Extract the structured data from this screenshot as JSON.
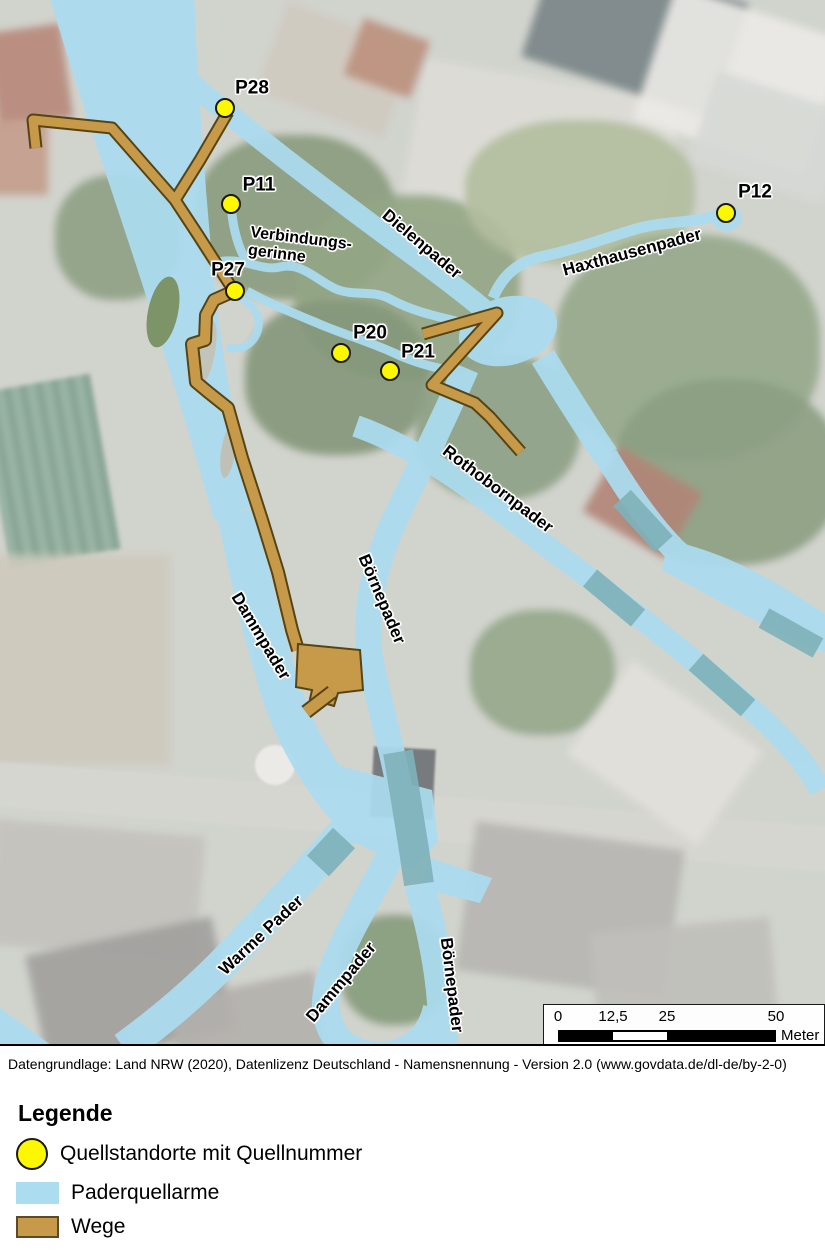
{
  "map": {
    "springs": [
      {
        "id": "P28",
        "x": 225,
        "y": 108,
        "lx": 252,
        "ly": 88
      },
      {
        "id": "P11",
        "x": 231,
        "y": 204,
        "lx": 259,
        "ly": 185
      },
      {
        "id": "P27",
        "x": 235,
        "y": 291,
        "lx": 228,
        "ly": 270
      },
      {
        "id": "P20",
        "x": 341,
        "y": 353,
        "lx": 370,
        "ly": 333
      },
      {
        "id": "P21",
        "x": 390,
        "y": 371,
        "lx": 418,
        "ly": 352
      },
      {
        "id": "P12",
        "x": 726,
        "y": 213,
        "lx": 755,
        "ly": 192
      }
    ],
    "channel_labels": [
      {
        "slug": "verbindungsgerinne",
        "text": "Verbindungs-\ngerinne",
        "x": 300,
        "y": 248,
        "rot": 7,
        "size": 16
      },
      {
        "slug": "dielenpader",
        "text": "Dielenpader",
        "x": 422,
        "y": 244,
        "rot": 40
      },
      {
        "slug": "haxthausenpader",
        "text": "Haxthausenpader",
        "x": 632,
        "y": 252,
        "rot": -15
      },
      {
        "slug": "rothobornpader",
        "text": "Rothobornpader",
        "x": 498,
        "y": 489,
        "rot": 37
      },
      {
        "slug": "boernepader-mitte",
        "text": "Börnepader",
        "x": 382,
        "y": 599,
        "rot": 67
      },
      {
        "slug": "dammpader-mitte",
        "text": "Dammpader",
        "x": 261,
        "y": 636,
        "rot": 59
      },
      {
        "slug": "warme-pader",
        "text": "Warme Pader",
        "x": 261,
        "y": 935,
        "rot": -43
      },
      {
        "slug": "dammpader-sued",
        "text": "Dammpader",
        "x": 341,
        "y": 982,
        "rot": -50
      },
      {
        "slug": "boernepader-sued",
        "text": "Börnepader",
        "x": 452,
        "y": 985,
        "rot": 83
      }
    ],
    "scalebar": {
      "ticks": [
        "0",
        "12,5",
        "25",
        "50"
      ],
      "tick_px": [
        14,
        69,
        123,
        232
      ],
      "unit": "Meter"
    }
  },
  "attribution": "Datengrundlage: Land NRW (2020), Datenlizenz Deutschland - Namensnennung - Version 2.0 (www.govdata.de/dl-de/by-2-0)",
  "legend": {
    "title": "Legende",
    "items": [
      {
        "label": "Quellstandorte mit Quellnummer",
        "swatch": "circle-yellow"
      },
      {
        "label": "Paderquellarme",
        "swatch": "rect-blue"
      },
      {
        "label": "Wege",
        "swatch": "rect-brown"
      }
    ]
  },
  "colors": {
    "water": "#abdcf0",
    "culvert": "#7fb2ba",
    "path_fill": "#c79a4a",
    "path_edge": "#564413",
    "spring_fill": "#fdf800",
    "spring_edge": "#1a1a1a"
  }
}
